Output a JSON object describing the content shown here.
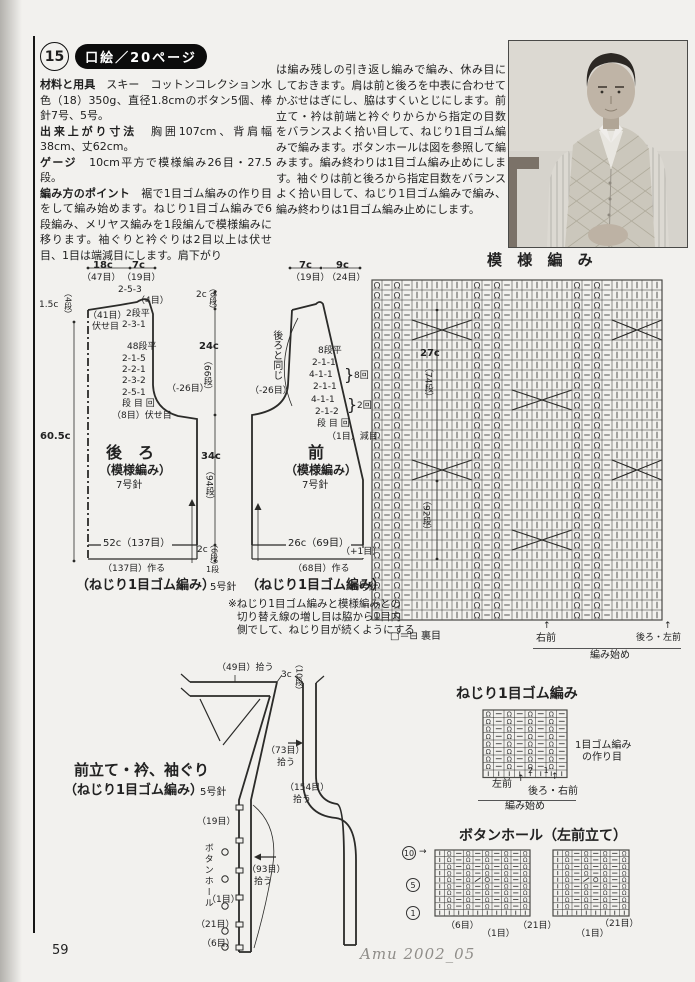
{
  "header": {
    "item_number": "15",
    "title": "口絵／20ページ"
  },
  "intro": {
    "label_materials": "材料と用具",
    "text_materials": "　スキー　コットンコレクション水色（18）350g、直径1.8cmのボタン5個、棒針7号、5号。",
    "label_size": "出来上がり寸法",
    "text_size": "　胸囲107cm、背肩幅38cm、丈62cm。",
    "label_gauge": "ゲージ",
    "text_gauge": "　10cm平方で模様編み26目・27.5段。",
    "label_points": "編み方のポイント",
    "text_points": "　裾で1目ゴム編みの作り目をして編み始めます。ねじり1目ゴム編みで6段編み、メリヤス編みを1段編んで模様編みに移ります。袖ぐりと衿ぐりは2目以上は伏せ目、1目は端減目にします。肩下がり",
    "text_continued": "は編み残しの引き返し編みで編み、休み目にしておきます。肩は前と後ろを中表に合わせてかぶせはぎにし、脇はすくいとじにします。前立て・衿は前端と衿ぐりからから指定の目数をバランスよく拾い目して、ねじり1目ゴム編みで編みます。ボタンホールは図を参照して編みます。編み終わりは1目ゴム編み止めにします。袖ぐりは前と後ろから指定目数をバランスよく拾い目して、ねじり1目ゴム編みで編み、編み終わりは1目ゴム編み止めにします。"
  },
  "back": {
    "width_top": "18c",
    "width_top_sts": "（47目）",
    "neck": "7c",
    "neck_sts": "（19目）",
    "shoulder_drop": "1.5c",
    "shoulder_rows": "（4段）",
    "neck_dec": "2-5-3",
    "neck_dec_sts": "（4目）",
    "bindoff_sts": "（41目）",
    "bindoff": "伏せ目",
    "flat": "2段平",
    "dec": "2-3-1",
    "armhole_lines": [
      "48段平",
      "2-1-5",
      "2-2-1",
      "2-3-2",
      "2-5-1",
      "段 目 回",
      "（8目）伏せ目"
    ],
    "armhole_total": "（-26目）",
    "length": "60.5c",
    "title": "後　ろ",
    "subtitle": "（模様編み）",
    "needle": "7号針",
    "hem": "52c（137目）",
    "cast_on": "（137目）作る",
    "rib_label": "（ねじり1目ゴム編み）",
    "rib_needle": "5号針",
    "dim_2c_top": "2c",
    "dim_6r_top": "（6段）",
    "dim_24c": "24c",
    "dim_66r": "（66段）",
    "dim_34c": "34c",
    "dim_94r": "（94段）",
    "dim_2c_hem": "2c",
    "dim_6r_hem": "（6段）",
    "dim_1r": "1段"
  },
  "front": {
    "shoulder": "7c",
    "shoulder_sts": "（19目）",
    "neck": "9c",
    "neck_sts": "（24目）",
    "same_as_back": "後ろと同じ",
    "vneck_lines": [
      "8段平",
      "2-1-1",
      "4-1-1",
      "2-1-1",
      "4-1-1",
      "2-1-2",
      "段 目 回"
    ],
    "brace": "}",
    "rep8": "8回",
    "rep2": "2回",
    "dec_note": "（1目）減目",
    "armhole_total": "（-26目）",
    "dim_27c": "27c",
    "dim_74r": "（74段）",
    "dim_92r": "（92段）",
    "title": "前",
    "subtitle": "（模様編み）",
    "needle": "7号針",
    "hem": "26c（69目）",
    "hem_plus": "（+1目）",
    "cast_on": "（68目）作る",
    "rib_label": "（ねじり1目ゴム編み）",
    "rib_needle": "5号針",
    "note1": "※ねじり1目ゴム編みと模様編みとの",
    "note2": "切り替え線の増し目は脇から1目内",
    "note3": "側でして、ねじり目が続くようにする"
  },
  "pattern_chart": {
    "title": "模 様 編 み",
    "legend": "□＝⊟ 裏目",
    "right_front": "右前",
    "back_left": "後ろ・左前",
    "start": "編み始め",
    "arrow": "↑"
  },
  "band": {
    "title": "前立て・衿、袖ぐり",
    "subtitle": "（ねじり1目ゴム編み）",
    "needle": "5号針",
    "pick_neck": "（49目）拾う",
    "w3c": "3c",
    "r10": "（10段）",
    "pick73": "（73目）",
    "pick154": "（154目）",
    "pick93": "（93目）",
    "pickup": "拾う",
    "s19": "（19目）",
    "buttonhole": "ボタンホール",
    "s1": "（1目）",
    "s21": "（21目）",
    "s6": "（6目）"
  },
  "rib_chart": {
    "title": "ねじり1目ゴム編み",
    "cast1": "1目ゴム編み",
    "cast2": "の作り目",
    "left_front": "左前",
    "back_right": "後ろ・右前",
    "start": "編み始め",
    "nums": "2 1",
    "arrow": "↑"
  },
  "bh_chart": {
    "title": "ボタンホール（左前立て）",
    "r10": "10",
    "r5": "5",
    "r1": "1",
    "arrow": "→",
    "l6": "（6目）",
    "l1a": "（1目）",
    "l21a": "（21目）",
    "l1b": "（1目）",
    "l21b": "（21目）"
  },
  "footer": {
    "page": "59",
    "credit": "Amu 2002_05"
  }
}
